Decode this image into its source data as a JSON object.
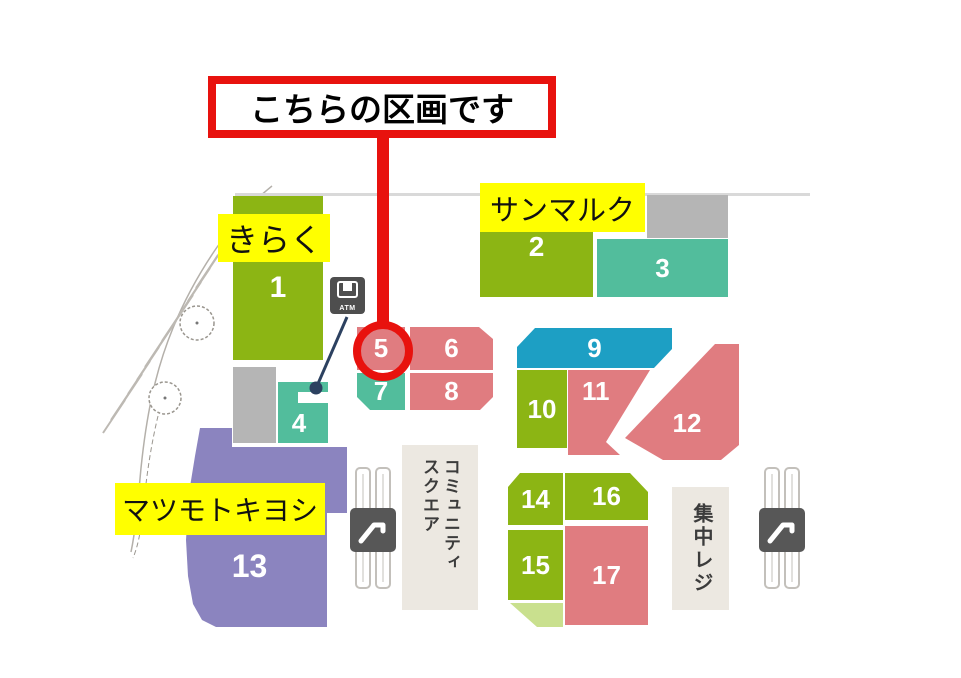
{
  "callout": {
    "text": "こちらの区画です"
  },
  "store_labels": {
    "kiraku": "きらく",
    "sanmarc": "サンマルク",
    "matsumotokiyoshi": "マツモトキヨシ"
  },
  "map": {
    "blocks": [
      {
        "number": "1",
        "color": "#8cb514"
      },
      {
        "number": "2",
        "color": "#8cb514"
      },
      {
        "number": "3",
        "color": "#52bd9c"
      },
      {
        "number": "4",
        "color": "#52bd9c"
      },
      {
        "number": "5",
        "color": "#e07c80",
        "highlighted": "red-circle"
      },
      {
        "number": "6",
        "color": "#e07c80"
      },
      {
        "number": "7",
        "color": "#52bd9c"
      },
      {
        "number": "8",
        "color": "#e07c80"
      },
      {
        "number": "9",
        "color": "#1d9fc4"
      },
      {
        "number": "10",
        "color": "#8cb514"
      },
      {
        "number": "11",
        "color": "#e07c80"
      },
      {
        "number": "12",
        "color": "#e07c80"
      },
      {
        "number": "13",
        "color": "#8b84bf"
      },
      {
        "number": "14",
        "color": "#8cb514"
      },
      {
        "number": "15",
        "color": "#8cb514"
      },
      {
        "number": "16",
        "color": "#8cb514"
      },
      {
        "number": "17",
        "color": "#e07c80"
      }
    ],
    "areas": {
      "community_square": {
        "column1": "コミュニティ",
        "column2": "スクエア"
      },
      "central_register": {
        "text": "集中レジ"
      }
    },
    "icons": {
      "atm_label": "ATM"
    },
    "colors": {
      "green": "#8cb514",
      "teal": "#52bd9c",
      "pink": "#e07c80",
      "cyan": "#1d9fc4",
      "purple": "#8b84bf",
      "gray": "#b5b5b5",
      "beige": "#ece8e1",
      "light_green": "#c9e08e",
      "highlight_yellow": "#ffff00",
      "annotation_red": "#e8120e",
      "connector_navy": "#2c4160"
    }
  }
}
